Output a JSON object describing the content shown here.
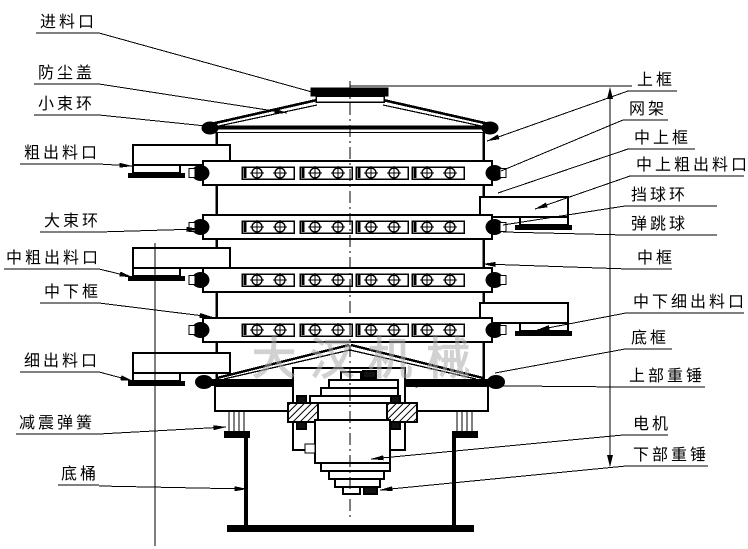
{
  "watermark": {
    "text": "大汉机械"
  },
  "drawing": {
    "line_color": "#000000",
    "watermark_color": "#adadad",
    "background": "#ffffff"
  },
  "labels": {
    "left": [
      {
        "id": "feed-inlet",
        "text": "进料口",
        "tx": 40,
        "ty": 27,
        "underline": [
          36,
          99,
          33
        ],
        "leader": [
          [
            99,
            33
          ],
          [
            312,
            92
          ]
        ],
        "arrow": false
      },
      {
        "id": "dust-cover",
        "text": "防尘盖",
        "tx": 38,
        "ty": 78,
        "underline": [
          34,
          99,
          84
        ],
        "leader": [
          [
            99,
            84
          ],
          [
            287,
            113
          ]
        ],
        "arrow": true
      },
      {
        "id": "small-clamp-ring",
        "text": "小束环",
        "tx": 38,
        "ty": 109,
        "underline": [
          34,
          99,
          115
        ],
        "leader": [
          [
            99,
            115
          ],
          [
            206,
            126
          ]
        ],
        "arrow": false
      },
      {
        "id": "coarse-outlet",
        "text": "粗出料口",
        "tx": 24,
        "ty": 158,
        "underline": [
          20,
          99,
          164
        ],
        "leader": [
          [
            99,
            164
          ],
          [
            132,
            166
          ]
        ],
        "arrow": true
      },
      {
        "id": "large-clamp-ring",
        "text": "大束环",
        "tx": 44,
        "ty": 226,
        "underline": [
          40,
          99,
          232
        ],
        "leader": [
          [
            99,
            232
          ],
          [
            199,
            229
          ]
        ],
        "arrow": true
      },
      {
        "id": "mid-coarse-outlet",
        "text": "中粗出料口",
        "tx": 6,
        "ty": 263,
        "underline": [
          4,
          99,
          269
        ],
        "leader": [
          [
            99,
            269
          ],
          [
            132,
            277
          ]
        ],
        "arrow": true
      },
      {
        "id": "mid-lower-frame",
        "text": "中下框",
        "tx": 44,
        "ty": 297,
        "underline": [
          40,
          99,
          303
        ],
        "leader": [
          [
            99,
            303
          ],
          [
            212,
            317
          ]
        ],
        "arrow": true
      },
      {
        "id": "fine-outlet",
        "text": "细出料口",
        "tx": 24,
        "ty": 366,
        "underline": [
          20,
          99,
          372
        ],
        "leader": [
          [
            99,
            372
          ],
          [
            133,
            381
          ]
        ],
        "arrow": true
      },
      {
        "id": "damping-spring",
        "text": "减震弹簧",
        "tx": 19,
        "ty": 428,
        "underline": [
          16,
          99,
          434
        ],
        "leader": [
          [
            99,
            434
          ],
          [
            226,
            427
          ]
        ],
        "arrow": true
      },
      {
        "id": "bottom-barrel",
        "text": "底桶",
        "tx": 61,
        "ty": 479,
        "underline": [
          58,
          99,
          485
        ],
        "leader": [
          [
            99,
            486
          ],
          [
            247,
            489
          ]
        ],
        "arrow": true
      }
    ],
    "right": [
      {
        "id": "upper-frame",
        "text": "上框",
        "tx": 637,
        "ty": 85,
        "underline": [
          628,
          677,
          91
        ],
        "leader": [
          [
            628,
            91
          ],
          [
            487,
            141
          ]
        ],
        "arrow": true
      },
      {
        "id": "screen-frame",
        "text": "网架",
        "tx": 629,
        "ty": 114,
        "underline": [
          623,
          668,
          120
        ],
        "leader": [
          [
            623,
            120
          ],
          [
            501,
            171
          ]
        ],
        "arrow": false
      },
      {
        "id": "mid-upper-frame",
        "text": "中上框",
        "tx": 634,
        "ty": 143,
        "underline": [
          628,
          695,
          149
        ],
        "leader": [
          [
            628,
            149
          ],
          [
            498,
            193
          ]
        ],
        "arrow": false
      },
      {
        "id": "mid-upper-coarse-outlet",
        "text": "中上粗出料口",
        "tx": 636,
        "ty": 170,
        "underline": [
          630,
          744,
          176
        ],
        "leader": [
          [
            630,
            176
          ],
          [
            535,
            209
          ]
        ],
        "arrow": true
      },
      {
        "id": "ball-stop-ring",
        "text": "挡球环",
        "tx": 631,
        "ty": 200,
        "underline": [
          625,
          717,
          206
        ],
        "leader": [
          [
            625,
            206
          ],
          [
            503,
            225
          ]
        ],
        "arrow": false
      },
      {
        "id": "bouncing-ball",
        "text": "弹跳球",
        "tx": 631,
        "ty": 229,
        "underline": [
          625,
          717,
          235
        ],
        "leader": [
          [
            625,
            235
          ],
          [
            503,
            232
          ]
        ],
        "arrow": false
      },
      {
        "id": "middle-frame",
        "text": "中框",
        "tx": 637,
        "ty": 263,
        "underline": [
          628,
          672,
          269
        ],
        "leader": [
          [
            628,
            269
          ],
          [
            483,
            264
          ]
        ],
        "arrow": true
      },
      {
        "id": "mid-lower-fine-outlet",
        "text": "中下细出料口",
        "tx": 633,
        "ty": 307,
        "underline": [
          626,
          744,
          313
        ],
        "leader": [
          [
            626,
            313
          ],
          [
            537,
            330
          ]
        ],
        "arrow": true
      },
      {
        "id": "bottom-frame",
        "text": "底框",
        "tx": 631,
        "ty": 343,
        "underline": [
          625,
          672,
          349
        ],
        "leader": [
          [
            625,
            349
          ],
          [
            495,
            373
          ]
        ],
        "arrow": false
      },
      {
        "id": "upper-weight",
        "text": "上部重锤",
        "tx": 629,
        "ty": 381,
        "underline": [
          623,
          705,
          387
        ],
        "leader": [
          [
            623,
            387
          ],
          [
            405,
            385
          ]
        ],
        "arrow": true
      },
      {
        "id": "motor",
        "text": "电机",
        "tx": 633,
        "ty": 429,
        "underline": [
          623,
          668,
          435
        ],
        "leader": [
          [
            623,
            435
          ],
          [
            371,
            459
          ]
        ],
        "arrow": true
      },
      {
        "id": "lower-weight",
        "text": "下部重锤",
        "tx": 633,
        "ty": 460,
        "underline": [
          626,
          708,
          466
        ],
        "leader": [
          [
            626,
            466
          ],
          [
            380,
            490
          ]
        ],
        "arrow": true
      }
    ]
  }
}
